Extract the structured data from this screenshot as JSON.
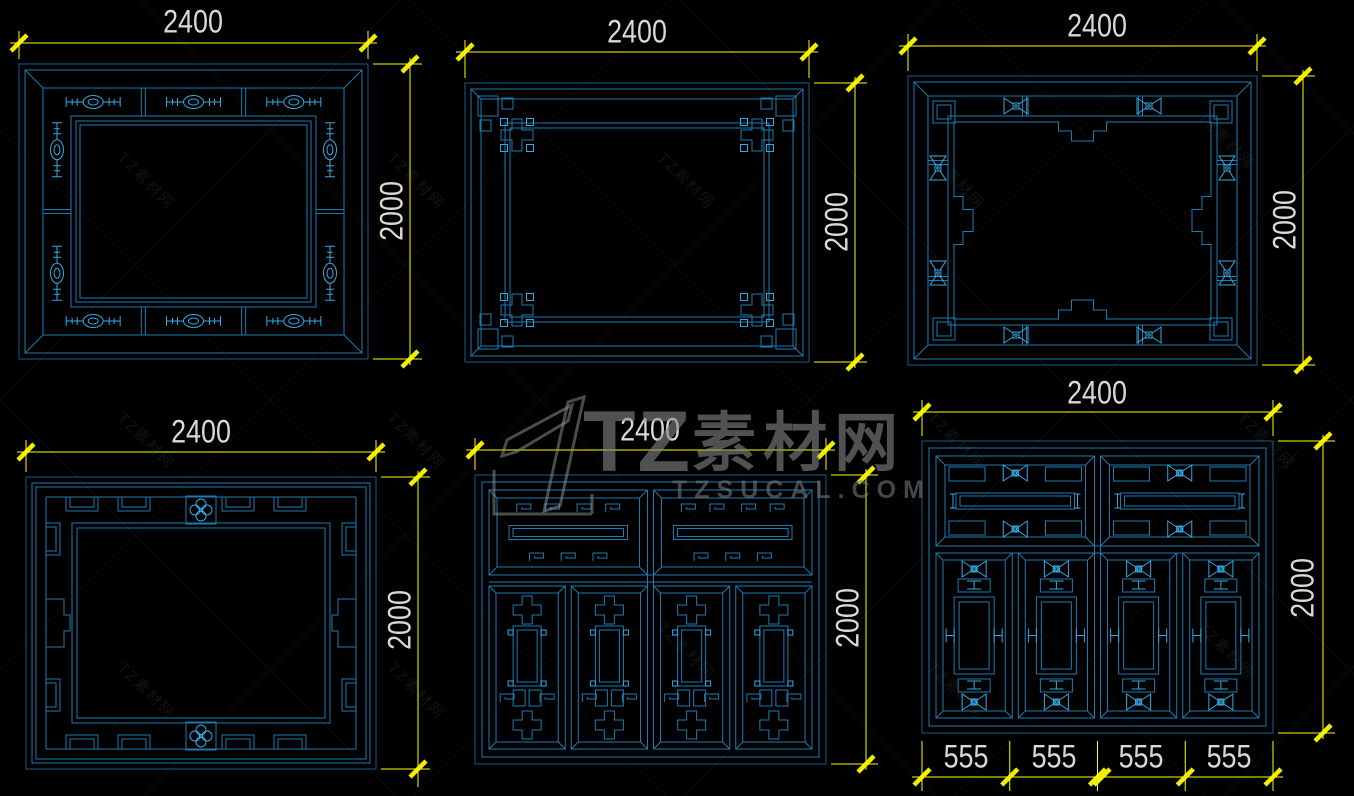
{
  "page": {
    "background": "#000000"
  },
  "colors": {
    "line_outer": "#145e88",
    "line_main": "#1c7cb2",
    "line_bright": "#34aae4",
    "dimension": "#ffff00",
    "tick": "#f2ee00",
    "dim_text": "#d9d9d9",
    "watermark": "#878787"
  },
  "watermark": {
    "brand_prefix": "TZ",
    "brand_suffix": "素材网",
    "brand_url": "TZSUCAL.COM"
  },
  "windows": [
    {
      "name": "band-with-oval-links",
      "width_label": "2400",
      "height_label": "2000"
    },
    {
      "name": "corner-fret-frame",
      "width_label": "2400",
      "height_label": "2000"
    },
    {
      "name": "notched-frame-bowties",
      "width_label": "2400",
      "height_label": "2000"
    },
    {
      "name": "meander-flower-frame",
      "width_label": "2400",
      "height_label": "2000"
    },
    {
      "name": "four-panel-lattice",
      "width_label": "2400",
      "height_label": "2000"
    },
    {
      "name": "four-panel-bar-lattice",
      "width_label": "2400",
      "height_label": "2000",
      "panel_labels": [
        "555",
        "555",
        "555",
        "555"
      ]
    }
  ]
}
